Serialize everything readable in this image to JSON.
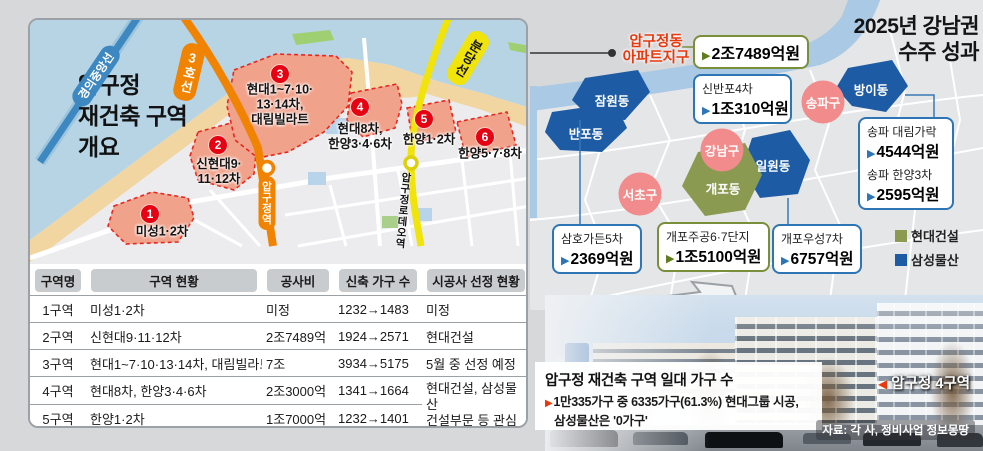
{
  "left_map": {
    "title_lines": [
      "압구정",
      "재건축 구역",
      "개요"
    ],
    "rail_labels": {
      "gyeongui_jungang": "경의중앙선",
      "line3": "3호선",
      "bundang": "분당선"
    },
    "stations": {
      "apgujeong": "압구정역",
      "rodeo": "압구정로데오역"
    },
    "zones": [
      {
        "no": "1",
        "label_lines": [
          "미성1·2차"
        ]
      },
      {
        "no": "2",
        "label_lines": [
          "신현대9·",
          "11·12차"
        ]
      },
      {
        "no": "3",
        "label_lines": [
          "현대1~7·10·",
          "13·14차,",
          "대림빌라트"
        ]
      },
      {
        "no": "4",
        "label_lines": [
          "현대8차,",
          "한양3·4·6차"
        ]
      },
      {
        "no": "5",
        "label_lines": [
          "한양1·2차"
        ]
      },
      {
        "no": "6",
        "label_lines": [
          "한양5·7·8차"
        ]
      }
    ]
  },
  "table": {
    "headers": [
      "구역명",
      "구역 현황",
      "공사비",
      "신축 가구 수",
      "시공사 선정 현황"
    ],
    "rows": [
      {
        "zone": "1구역",
        "status": "미성1·2차",
        "cost": "미정",
        "units": "1232→1483",
        "builder": "미정"
      },
      {
        "zone": "2구역",
        "status": "신현대9·11·12차",
        "cost": "2조7489억",
        "units": "1924→2571",
        "builder": "현대건설"
      },
      {
        "zone": "3구역",
        "status": "현대1~7·10·13·14차, 대림빌라트",
        "cost": "7조",
        "units": "3934→5175",
        "builder": "5월 중 선정 예정"
      },
      {
        "zone": "4구역",
        "status": "현대8차, 한양3·4·6차",
        "cost": "2조3000억",
        "units": "1341→1664",
        "builder_line1": "현대건설, 삼성물산",
        "builder_line2": "건설부문 등 관심"
      },
      {
        "zone": "5구역",
        "status": "한양1·2차",
        "cost": "1조7000억",
        "units": "1232→1401"
      },
      {
        "zone": "6구역",
        "status": "한양5·7·8차",
        "cost": "미정",
        "units": "672→898",
        "builder": "미정"
      }
    ]
  },
  "right_map": {
    "title_lines": [
      "2025년 강남권",
      "수주 성과"
    ],
    "arrow_glyph": "▶",
    "callout": {
      "name_lines": [
        "압구정동",
        "아파트지구"
      ],
      "amount": "2조7489억원"
    },
    "districts": {
      "jamwon": "잠원동",
      "banpo": "반포동",
      "bangi": "방이동",
      "irwon": "일원동",
      "gaepo": "개포동"
    },
    "gu": {
      "gangnam": "강남구",
      "seocho": "서초구",
      "songpa": "송파구"
    },
    "boxes": {
      "sinbanpo": {
        "name": "신반포4차",
        "amount": "1조310억원"
      },
      "songpa": {
        "name1": "송파 대림가락",
        "amount1": "4544억원",
        "name2": "송파 한양3차",
        "amount2": "2595억원"
      },
      "samho": {
        "name": "삼호가든5차",
        "amount": "2369억원"
      },
      "gaepo_jugong": {
        "name": "개포주공6·7단지",
        "amount": "1조5100억원"
      },
      "gaepo_useong": {
        "name": "개포우성7차",
        "amount": "6757억원"
      }
    },
    "legend": [
      {
        "label": "현대건설",
        "color": "#8a9a50"
      },
      {
        "label": "삼성물산",
        "color": "#1d5ba5"
      }
    ]
  },
  "photo": {
    "area_label": "압구정 4구역",
    "marker_glyph": "◀",
    "overlay": {
      "title": "압구정 재건축 구역 일대 가구 수",
      "bullet": "▶",
      "line1": "1만335가구 중 6335가구(61.3%) 현대그룹 시공,",
      "line2": "삼성물산은 '0가구'"
    },
    "source": "자료: 각 사, 정비사업 정보몽땅"
  },
  "colors": {
    "hyundai_green": "#8a9a50",
    "samsung_blue": "#1d5ba5",
    "zone_fill": "#f1a28b",
    "zone_border": "#e8281e",
    "line3_orange": "#f08300",
    "bundang_yellow": "#f0e40a",
    "gyeongui_blue": "#3d88c0",
    "red_accent": "#e8380d",
    "gu_pink": "#f28b8b"
  }
}
